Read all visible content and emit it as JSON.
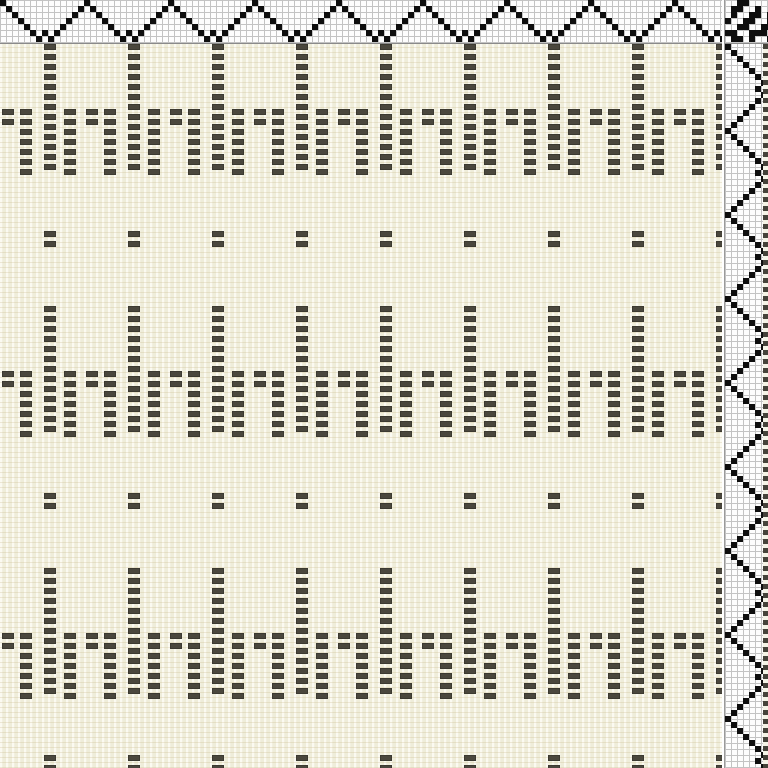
{
  "window": {
    "kind": "weaving-draft-view",
    "width_px": 768,
    "height_px": 768,
    "visible_text": ""
  },
  "colors": {
    "draft_grid_line": "#c3c3c3",
    "draft_grid_bg": "#fdfdfd",
    "draft_cell_black": "#0e0e0e",
    "drawdown_bg_cream": "#f2f0e0",
    "drawdown_warp_stripe_light": "#fbfaf1",
    "drawdown_warp_stripe_dark": "#efedda",
    "drawdown_mark": "#4a473d",
    "separator_line": "#8a8a8a"
  },
  "draft": {
    "cell_px": 6,
    "threading": {
      "x": 0,
      "y": 0,
      "w": 722,
      "h": 43,
      "pattern_name": "point-twill-with-wiggle",
      "sequence_rows_top0": [
        0,
        1,
        2,
        3,
        4,
        5,
        6,
        5,
        6,
        5,
        4,
        3,
        2,
        1
      ],
      "repeat_cols": 121
    },
    "tieup": {
      "x": 724,
      "y": 0,
      "w": 44,
      "h": 43,
      "matrix": [
        [
          0,
          0,
          1,
          1,
          0,
          0,
          0,
          0
        ],
        [
          0,
          1,
          1,
          0,
          0,
          1,
          0,
          0
        ],
        [
          0,
          1,
          0,
          0,
          1,
          1,
          0,
          1
        ],
        [
          1,
          0,
          0,
          1,
          1,
          0,
          0,
          1
        ],
        [
          0,
          0,
          1,
          1,
          0,
          0,
          1,
          1
        ],
        [
          1,
          1,
          0,
          0,
          1,
          1,
          1,
          0
        ],
        [
          0,
          1,
          1,
          0,
          1,
          0,
          0,
          1
        ]
      ]
    },
    "treadling": {
      "x": 724,
      "y": 44,
      "w": 38,
      "h": 724,
      "pattern_name": "point-twill-with-wiggle",
      "sequence_cols": [
        0,
        1,
        2,
        3,
        4,
        5,
        6,
        5,
        6,
        5,
        4,
        3,
        2,
        1
      ],
      "repeat_rows": 121
    },
    "edge_column": {
      "x": 763,
      "y": 44,
      "w": 5,
      "h": 724,
      "pitch_y": 9,
      "mark_h": 5
    },
    "drawdown": {
      "x": 0,
      "y": 44,
      "w": 722,
      "h": 724,
      "tile_w": 84,
      "tile_x0": 44,
      "tile_from": -1,
      "tile_to": 8,
      "band_h": 262,
      "bands": 3,
      "mark": {
        "w": 12,
        "h": 6,
        "pitch_y": 10
      },
      "columns": [
        {
          "name": "tall-column",
          "dx": 0,
          "dy": 0,
          "marks": 13
        },
        {
          "name": "mid-left",
          "dx": 20,
          "dy": 65,
          "marks": 7
        },
        {
          "name": "tiny-center",
          "dx": 42,
          "dy": 65,
          "marks": 2
        },
        {
          "name": "mid-right",
          "dx": 60,
          "dy": 65,
          "marks": 7
        },
        {
          "name": "sparse-pair",
          "dx": 0,
          "dy": 187,
          "marks": 2
        }
      ]
    }
  }
}
